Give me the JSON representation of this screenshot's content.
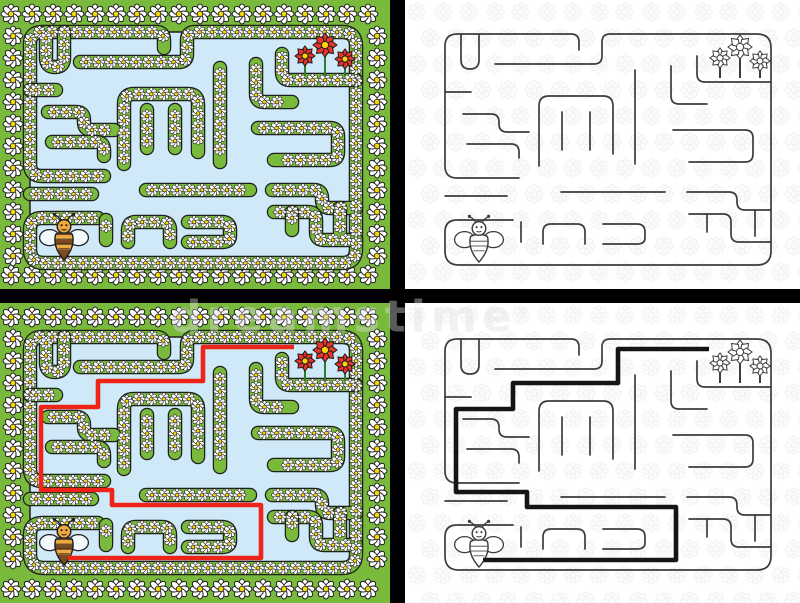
{
  "image": {
    "subject": "Easy bee maze for kids worksheet, color and outline versions with solutions",
    "width": 800,
    "height": 603
  },
  "watermark": {
    "text": "dreamstime",
    "registered_mark": "®"
  },
  "colors": {
    "grass_green": "#79b93c",
    "path_blue": "#cfe9f8",
    "dark_outline": "#1f1f1f",
    "bw_line": "#3c3c3c",
    "red_solution": "#ee2418",
    "black_solution": "#151515",
    "daisy_petal": "#ffffff",
    "daisy_center": "#f7d808",
    "pattern_gray": "#e4e4e4",
    "pattern_fill": "#fafafa",
    "flower_red": "#e8342a",
    "flower_center": "#ffd400",
    "stem_green": "#2e7d32",
    "bee_amber": "#efa93e",
    "bee_brown": "#7c4a1e",
    "bee_wing": "#f2fafd",
    "watermark_gray": "#e1e1e1",
    "separator_black": "#000000"
  },
  "maze": {
    "width": 330,
    "height": 235,
    "walls": [
      "M76,146 H14 Q2,146 2,134 V14 Q2,2 14,2 H128 Q136,2 136,10 V18",
      "M52,32 H151 Q159,32 159,24 V10 Q159,2 167,2 H314 Q328,2 328,16 V219 Q328,233 314,233 H16 Q2,233 2,219 V200 Q2,188 14,188 H70",
      "M78,190 V210",
      "M328,50 H262 Q254,50 254,42 V24",
      "M18,2 V28 Q18,37 27,37 36,37 36,28 V2",
      "M192,38 V132",
      "M96,134 V74 Q96,64 106,64 H160 Q170,64 170,74 V122",
      "M119,80 V118",
      "M147,80 V118",
      "M20,82 H48 Q56,82 56,90 V92 Q56,100 64,100 H86",
      "M2,60 H28",
      "M24,112 H68 Q76,112 76,120 V126",
      "M2,164 H64",
      "M118,160 H222",
      "M244,160 H286 Q294,160 294,168 V170 Q294,178 302,178 H328",
      "M246,182 H280 Q288,182 288,190 V202 Q288,210 296,210 H328",
      "M264,182 V200",
      "M230,98 H302 Q310,98 310,106 V122 Q310,130 302,130 H246",
      "M228,34 V64 Q228,72 236,72 H264",
      "M160,192 H194 Q202,192 202,200 V206 Q202,212 194,212 H160",
      "M100,212 V200 Q100,192 108,192 H134 Q142,192 142,200 V212",
      "M312,178 V204"
    ],
    "solution": [
      [
        40,
        223
      ],
      [
        233,
        223
      ],
      [
        233,
        170
      ],
      [
        84,
        170
      ],
      [
        84,
        155
      ],
      [
        13,
        155
      ],
      [
        13,
        72
      ],
      [
        70,
        72
      ],
      [
        70,
        46
      ],
      [
        175,
        46
      ],
      [
        175,
        12
      ],
      [
        266,
        12
      ]
    ],
    "bee": {
      "x": 36,
      "y": 210,
      "scale": 0.8
    },
    "goal_flowers": [
      {
        "x": 277,
        "y": 26,
        "r": 10
      },
      {
        "x": 297,
        "y": 15,
        "r": 12
      },
      {
        "x": 317,
        "y": 29,
        "r": 10
      }
    ],
    "flower_bed_y": 46
  },
  "panels": [
    {
      "name": "maze-panel-colored",
      "x": 0,
      "y": 0,
      "w": 390,
      "h": 289,
      "style": "color",
      "solution": false,
      "maze_x": 28,
      "maze_y": 30
    },
    {
      "name": "maze-panel-outline",
      "x": 405,
      "y": 0,
      "w": 395,
      "h": 289,
      "style": "bw",
      "solution": false,
      "maze_x": 38,
      "maze_y": 32
    },
    {
      "name": "maze-panel-colored-solved",
      "x": 0,
      "y": 303,
      "w": 390,
      "h": 300,
      "style": "color",
      "solution": true,
      "maze_x": 28,
      "maze_y": 32
    },
    {
      "name": "maze-panel-outline-solved",
      "x": 405,
      "y": 303,
      "w": 395,
      "h": 300,
      "style": "bw",
      "solution": true,
      "maze_x": 38,
      "maze_y": 34
    }
  ],
  "render": {
    "wall_band_black": 14.5,
    "wall_band_green": 12,
    "bw_line_width": 1.7,
    "solution_width": 4.6,
    "wall_daisy_radius": 5.2,
    "wall_daisy_spacing": 12.5,
    "ring_daisy_radius": 8,
    "ring_spacing_x": 21,
    "ring_spacing_y": 22,
    "pattern_step": 26,
    "pattern_radius": 7.5
  }
}
